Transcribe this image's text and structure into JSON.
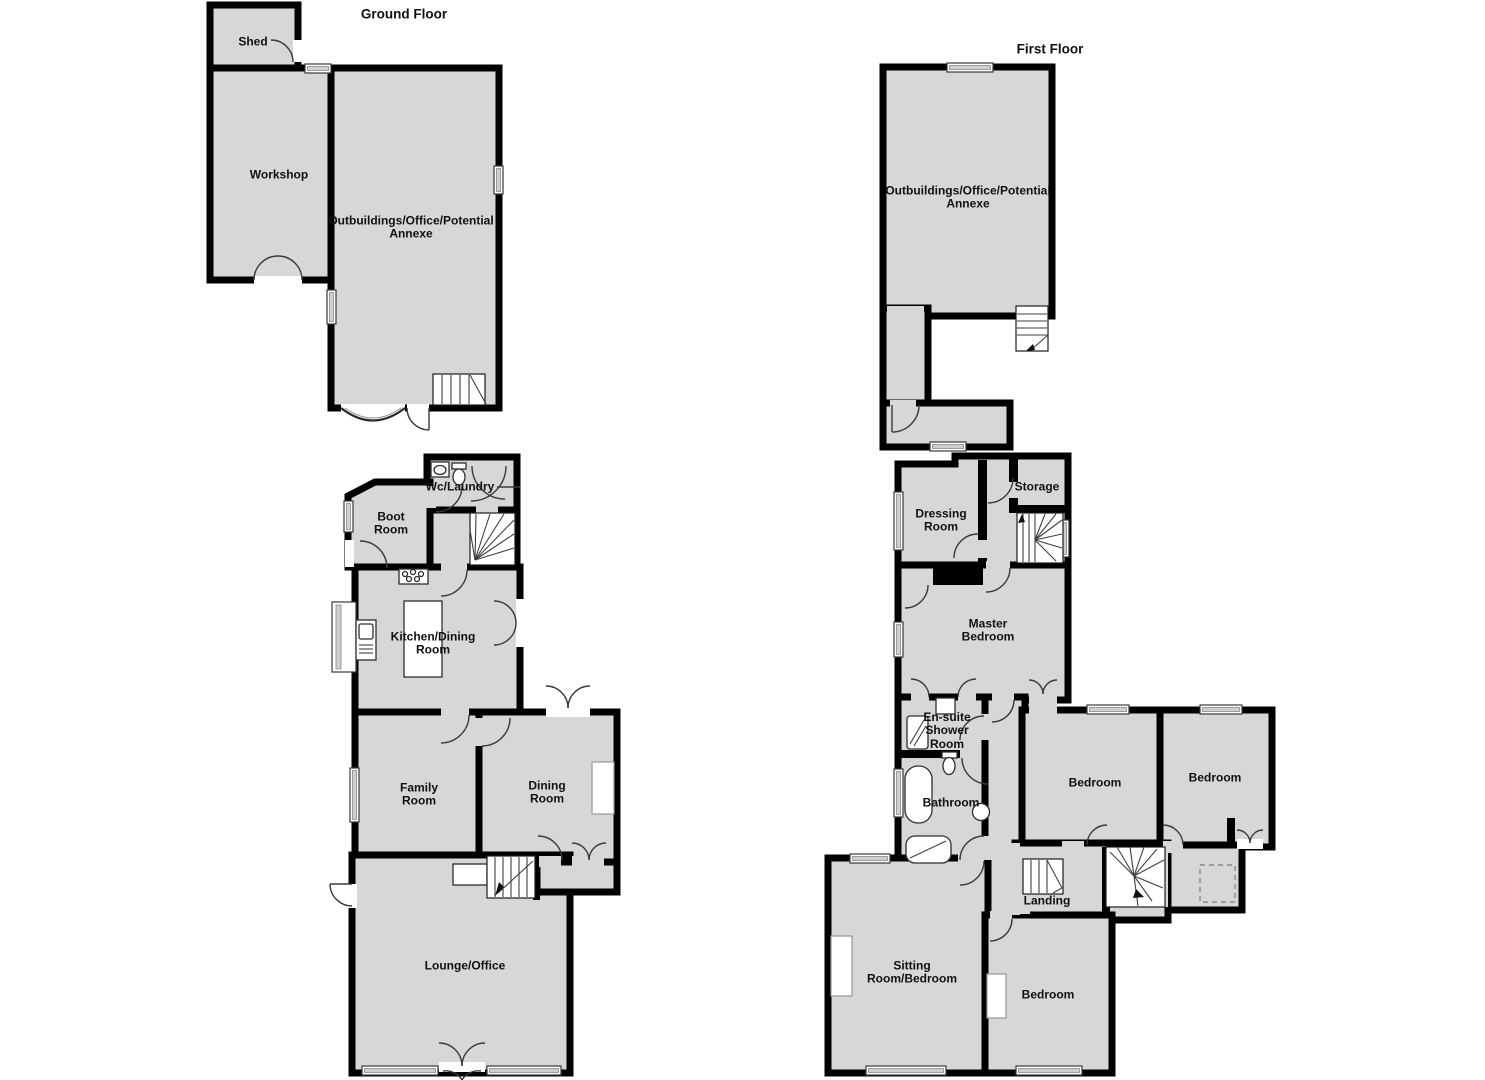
{
  "plan_titles": {
    "ground_floor": "Ground Floor",
    "first_floor": "First Floor"
  },
  "outbuilding_ground": {
    "shed": "Shed",
    "workshop": "Workshop",
    "annexe": "Outbuildings/Office/Potential\nAnnexe"
  },
  "outbuilding_first": {
    "annexe": "Outbuildings/Office/Potential\nAnnexe"
  },
  "house_ground": {
    "wc_laundry": "Wc/Laundry",
    "boot_room": "Boot\nRoom",
    "kitchen_dining": "Kitchen/Dining\nRoom",
    "family_room": "Family\nRoom",
    "dining_room": "Dining\nRoom",
    "lounge_office": "Lounge/Office"
  },
  "house_first": {
    "dressing_room": "Dressing\nRoom",
    "storage": "Storage",
    "master_bedroom": "Master\nBedroom",
    "ensuite_shower_room": "En-suite\nShower\nRoom",
    "bathroom": "Bathroom",
    "bedroom_left": "Bedroom",
    "bedroom_right": "Bedroom",
    "landing": "Landing",
    "sitting_room_bedroom": "Sitting\nRoom/Bedroom",
    "bedroom_lower": "Bedroom"
  },
  "colors": {
    "room_fill": "#d7d7d7",
    "wall": "#000000",
    "background": "#ffffff",
    "label_text": "#111111"
  }
}
